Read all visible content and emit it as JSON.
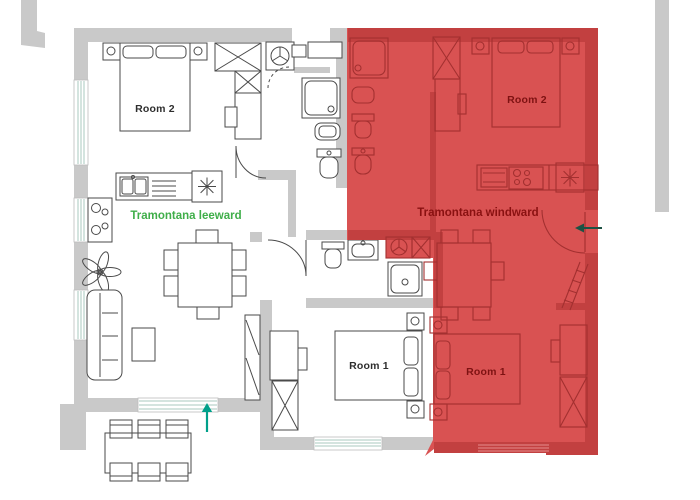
{
  "plan": {
    "title": "Two-unit apartment floor plan",
    "units": {
      "left": {
        "name": "Tramontana leeward",
        "rooms": [
          {
            "label": "Room 2"
          },
          {
            "label": "Room 1"
          }
        ]
      },
      "right": {
        "name": "Tramontana windward",
        "rooms": [
          {
            "label": "Room 2"
          },
          {
            "label": "Room 1"
          }
        ]
      }
    },
    "colors": {
      "wall_gray": "#c9c9c9",
      "line_dark": "#4a4a4a",
      "highlight_red": "#d95252",
      "highlight_red_dark": "#c24040",
      "red_line": "#a33030",
      "green_label": "#3fae49",
      "red_label": "#8a1111",
      "arrow_teal": "#00a08a",
      "window_line": "#a9c8bf"
    },
    "icons": {
      "washing_machine": "circle-with-spokes",
      "fridge_snowflake": "asterisk-star",
      "wardrobe": "crossed-box",
      "entrance_arrow": "arrow"
    }
  }
}
